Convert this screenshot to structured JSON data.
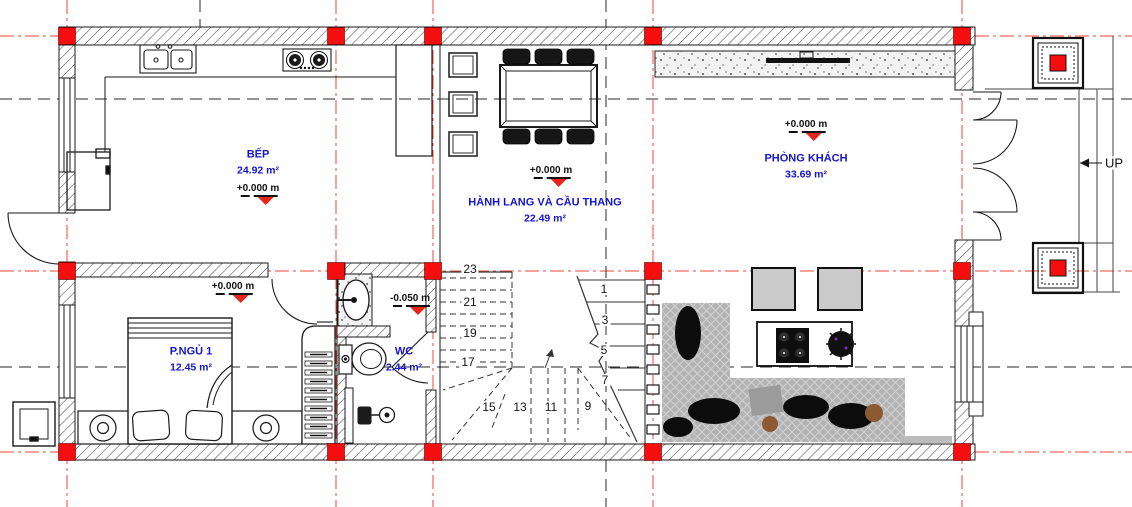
{
  "drawing_type": "architectural floor plan - ground floor",
  "colors": {
    "label_blue": "#1414cc",
    "grid_red": "#f03022",
    "column_red": "#f60d0d",
    "level_marker_red": "#e8251a",
    "line_black": "#1a1a1a",
    "sofa_gray": "#b3b3b3"
  },
  "rooms": {
    "kitchen": {
      "name": "BẾP",
      "area": "24.92 m²",
      "level": "+0.000 m"
    },
    "hallway": {
      "name": "HÀNH LANG VÀ CẦU THANG",
      "area": "22.49 m²",
      "level": "+0.000 m"
    },
    "living": {
      "name": "PHÒNG KHÁCH",
      "area": "33.69 m²",
      "level": "+0.000 m"
    },
    "bedroom": {
      "name": "P.NGỦ 1",
      "area": "12.45 m²",
      "level": "+0.000 m"
    },
    "wc": {
      "name": "WC",
      "area": "2.44 m²",
      "level": "-0.050 m"
    }
  },
  "stairs": {
    "numbers": [
      "23",
      "21",
      "19",
      "17",
      "15",
      "13",
      "11",
      "9",
      "1",
      "3",
      "5",
      "7"
    ]
  },
  "navigation": {
    "up_label": "UP"
  }
}
